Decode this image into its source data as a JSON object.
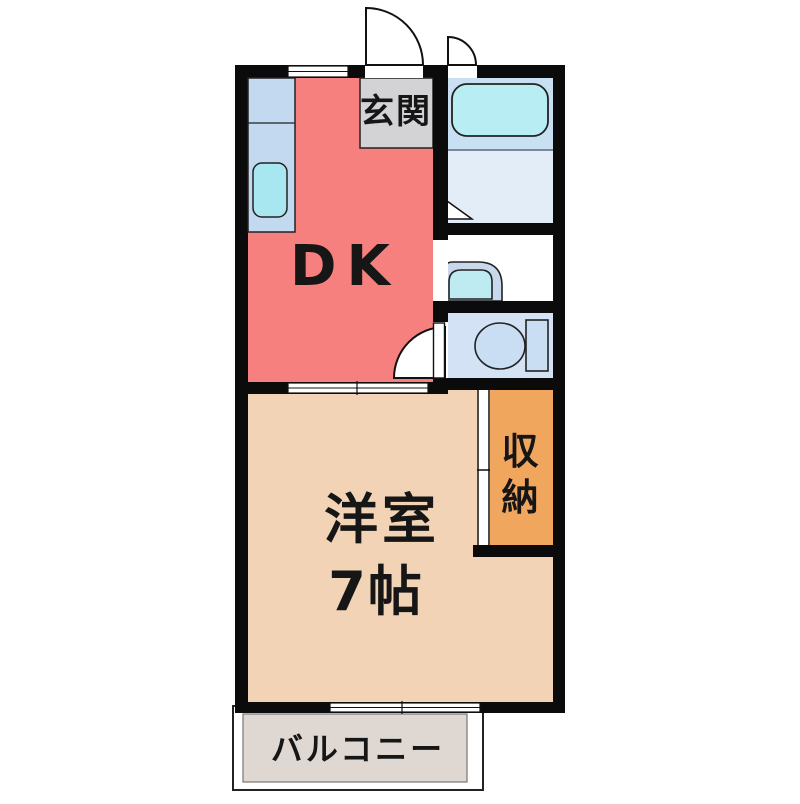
{
  "plan": {
    "type_note": "floor-plan",
    "rooms": {
      "dk": {
        "label": "DK",
        "color": "#f5807e"
      },
      "genkan": {
        "label": "玄関",
        "color": "#d3d3d6"
      },
      "western": {
        "label_line1": "洋室",
        "label_line2": "7帖",
        "color": "#f2d3b5"
      },
      "storage": {
        "chars": [
          "収",
          "納"
        ],
        "color": "#f1a65e"
      },
      "balcony": {
        "label": "バルコニー",
        "color": "#dfd8d2"
      },
      "bathroom": {
        "upper_color": "#c9dff2",
        "lower_color": "#e3edf8"
      },
      "washroom": {
        "floor_color": "#ffffff"
      },
      "toilet_room": {
        "floor_color": "#d3e3f5"
      }
    },
    "fixtures": {
      "counter_color": "#c3d9ef",
      "kitchen_sink_color": "#a9e7f0",
      "bathtub_color": "#b7edf3",
      "washbasin_body_color": "#c9d8ea",
      "washbasin_bowl_color": "#beeaf2",
      "toilet_color": "#c9def3"
    },
    "wall_color": "#0b0b0b",
    "text_color": "#161616"
  }
}
